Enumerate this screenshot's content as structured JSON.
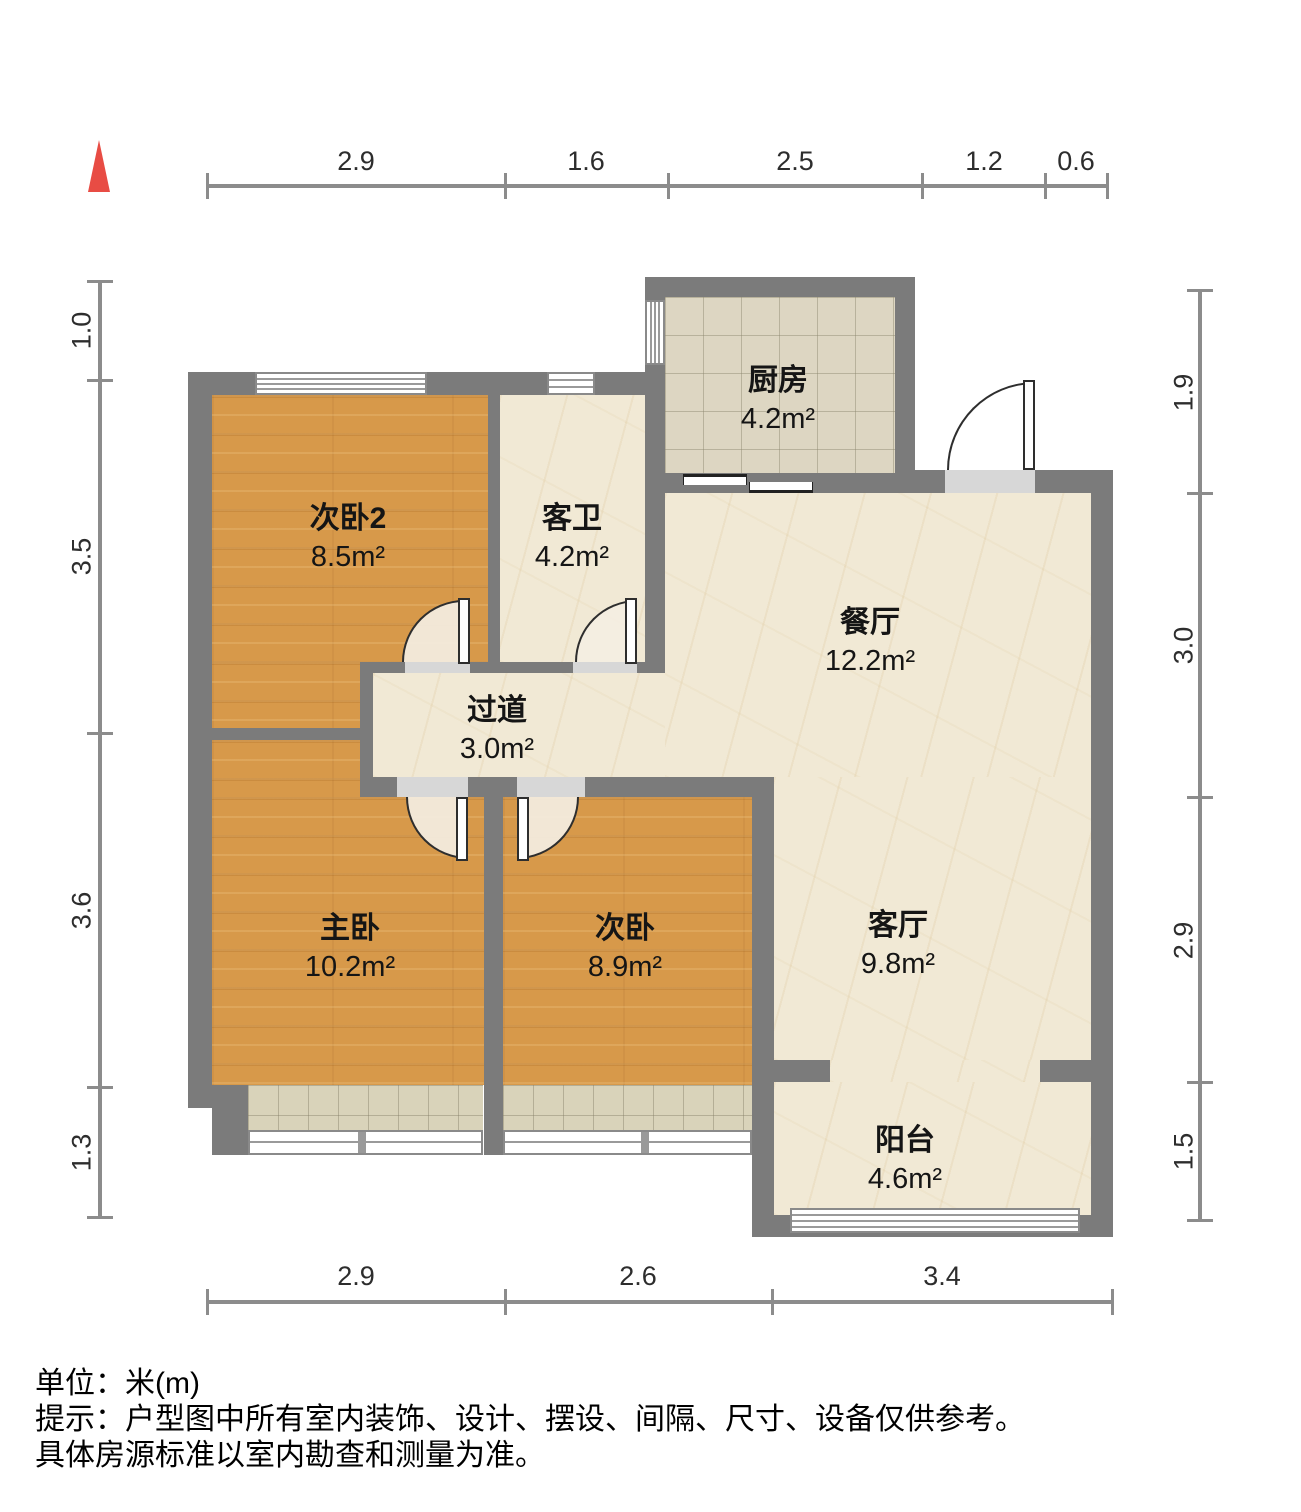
{
  "compass": {
    "icon": "north-indicator",
    "color": "#e84c44"
  },
  "rooms": [
    {
      "name": "次卧2",
      "area": "8.5m²"
    },
    {
      "name": "客卫",
      "area": "4.2m²"
    },
    {
      "name": "厨房",
      "area": "4.2m²"
    },
    {
      "name": "餐厅",
      "area": "12.2m²"
    },
    {
      "name": "过道",
      "area": "3.0m²"
    },
    {
      "name": "主卧",
      "area": "10.2m²"
    },
    {
      "name": "次卧",
      "area": "8.9m²"
    },
    {
      "name": "客厅",
      "area": "9.8m²"
    },
    {
      "name": "阳台",
      "area": "4.6m²"
    }
  ],
  "dimensions": {
    "top": [
      "2.9",
      "1.6",
      "2.5",
      "1.2",
      "0.6"
    ],
    "left": [
      "1.0",
      "3.5",
      "3.6",
      "1.3"
    ],
    "right": [
      "1.9",
      "3.0",
      "2.9",
      "1.5"
    ],
    "bottom": [
      "2.9",
      "2.6",
      "3.4"
    ]
  },
  "footer": {
    "line1": "单位：米(m)",
    "line2": "提示：户型图中所有室内装饰、设计、摆设、间隔、尺寸、设备仅供参考。",
    "line3": "具体房源标准以室内勘查和测量为准。"
  },
  "colors": {
    "wall": "#7b7b7b",
    "wood_floor": "#d7994a",
    "marble_floor": "#f1e9d5",
    "kitchen_tile": "#ddd6c2",
    "bay_tile": "#d9d3ba",
    "accent_red": "#e84c44",
    "dim_line": "#8c8c8c"
  }
}
